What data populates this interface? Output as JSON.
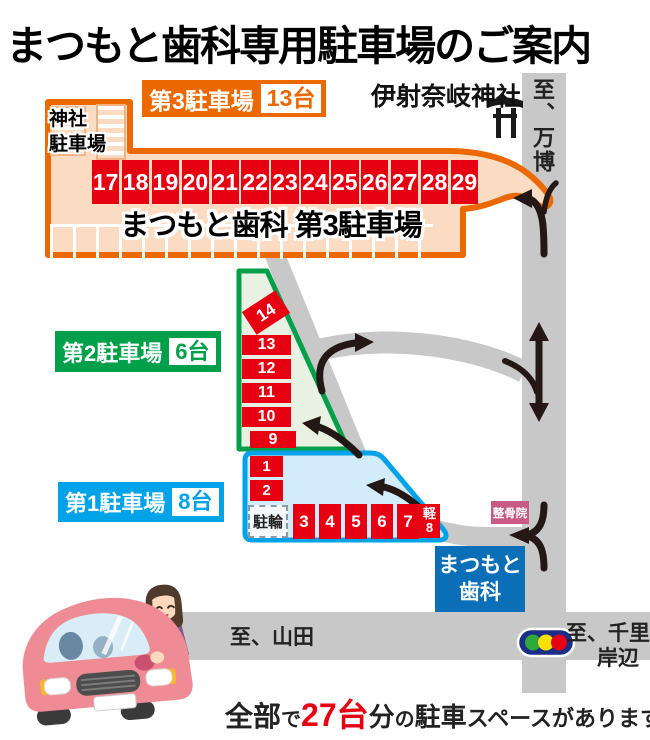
{
  "title": "まつもと歯科専用駐車場のご案内",
  "lot3": {
    "label": "第3駐車場",
    "capacity": "13台",
    "name": "まつもと歯科 第3駐車場",
    "shrine_parking_line1": "神社",
    "shrine_parking_line2": "駐車場",
    "spaces": [
      "17",
      "18",
      "19",
      "20",
      "21",
      "22",
      "23",
      "24",
      "25",
      "26",
      "27",
      "28",
      "29"
    ]
  },
  "lot2": {
    "label": "第2駐車場",
    "capacity": "6台",
    "rotated_space": "14",
    "spaces": [
      "13",
      "12",
      "11",
      "10",
      "9"
    ]
  },
  "lot1": {
    "label": "第1駐車場",
    "capacity": "8台",
    "space1": "1",
    "space2": "2",
    "bicycle": "駐輪",
    "spaces": [
      "3",
      "4",
      "5",
      "6",
      "7"
    ],
    "kei_line1": "軽",
    "kei_line2": "8"
  },
  "landmarks": {
    "shrine": "伊射奈岐神社",
    "clinic_line1": "まつもと",
    "clinic_line2": "歯科",
    "osteopath": "整骨院"
  },
  "roads": {
    "north": "至、万博",
    "west": "至、山田",
    "east_line1": "至、千里丘",
    "east_line2": "岸辺"
  },
  "footer": {
    "p1": "全部",
    "p2": "で",
    "p3": "27台",
    "p4": "分",
    "p5": "の",
    "p6": "駐車",
    "p7": "スペースがあります"
  },
  "colors": {
    "orange": "#ec6800",
    "red": "#e60012",
    "green": "#00a04a",
    "blue": "#00a2e8",
    "clinic_blue": "#0b6fb8",
    "peach": "#fbdcc2",
    "road_gray": "#c8c8c9",
    "osteopath_pink": "#c75b83",
    "arrow_black": "#231815",
    "signal_green": "#2fa83c",
    "signal_yellow": "#ffe100",
    "signal_red": "#e60012"
  }
}
